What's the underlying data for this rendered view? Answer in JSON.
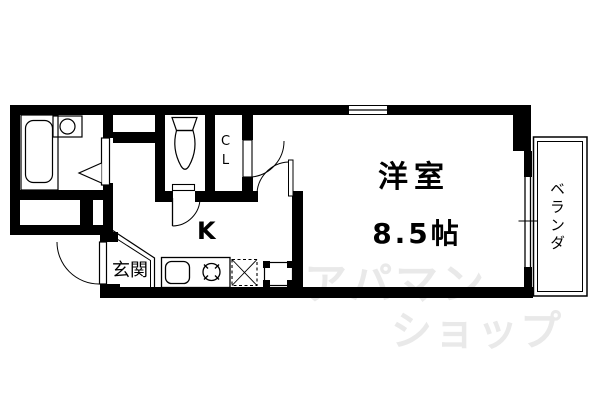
{
  "document": {
    "type": "apartment-floor-plan"
  },
  "rooms": {
    "western_room": {
      "name": "洋室",
      "size": "8.5帖"
    },
    "kitchen": {
      "label": "K"
    },
    "entrance": {
      "label": "玄関"
    },
    "closet": {
      "label": "CL"
    },
    "balcony": {
      "label": "ベランダ"
    }
  },
  "watermark": {
    "line1": "アパマン",
    "line2": "ショップ"
  },
  "colors": {
    "wall": "#000000",
    "background": "#ffffff",
    "watermark": "#e9e9e9"
  },
  "fixtures": [
    "bathtub",
    "washbasin",
    "toilet",
    "kitchen-sink",
    "gas-stove",
    "refrigerator-space",
    "washing-machine-pan",
    "sliding-window",
    "entrance-door",
    "folding-bath-door"
  ]
}
